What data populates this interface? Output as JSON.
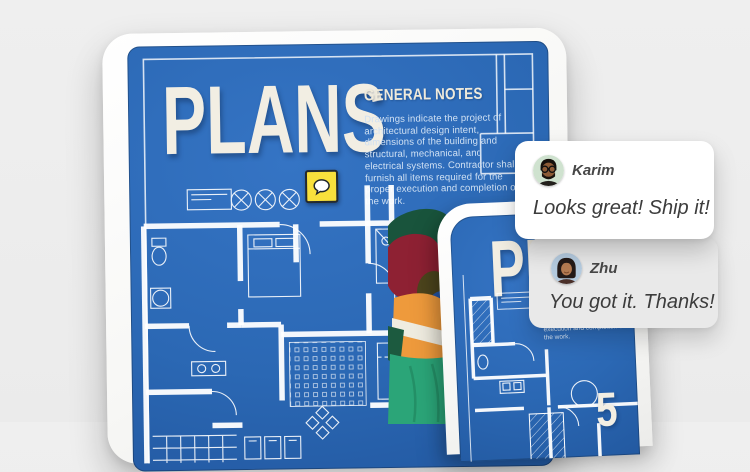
{
  "colors": {
    "background": "#ededed",
    "blueprint_blue": "#2b68b4",
    "blueprint_line": "#ffffff",
    "title_cream": "#f2eee3",
    "pin_yellow": "#f8e03c",
    "card_white": "#ffffff",
    "card_gray": "#e9e9e9",
    "comment_text": "#3c3c3c",
    "vest_orange": "#ee9a3c",
    "hair_maroon": "#8e2133",
    "outfit_teal": "#2ba578"
  },
  "tablet": {
    "title": "PLANS",
    "notes_heading": "GENERAL NOTES",
    "notes_body": "Drawings indicate the project of architectural design intent, dimensions of the building and structural, mechanical, and electrical systems. Contractor shall furnish all items required for the proper execution and completion of the work."
  },
  "phone": {
    "title": "PLANS",
    "notes_body": "Drawings indicate the project of architectural design intent, dimensions of the building and structural, mechanical, and electrical systems. Contractor shall furnish all items required for the proper execution and completion of the work.",
    "sheet_number": "5"
  },
  "annotation": {
    "comment_pin_icon": "speech-bubble"
  },
  "comments": [
    {
      "author": "Karim",
      "message": "Looks great! Ship it!"
    },
    {
      "author": "Zhu",
      "message": "You got it. Thanks!"
    }
  ]
}
